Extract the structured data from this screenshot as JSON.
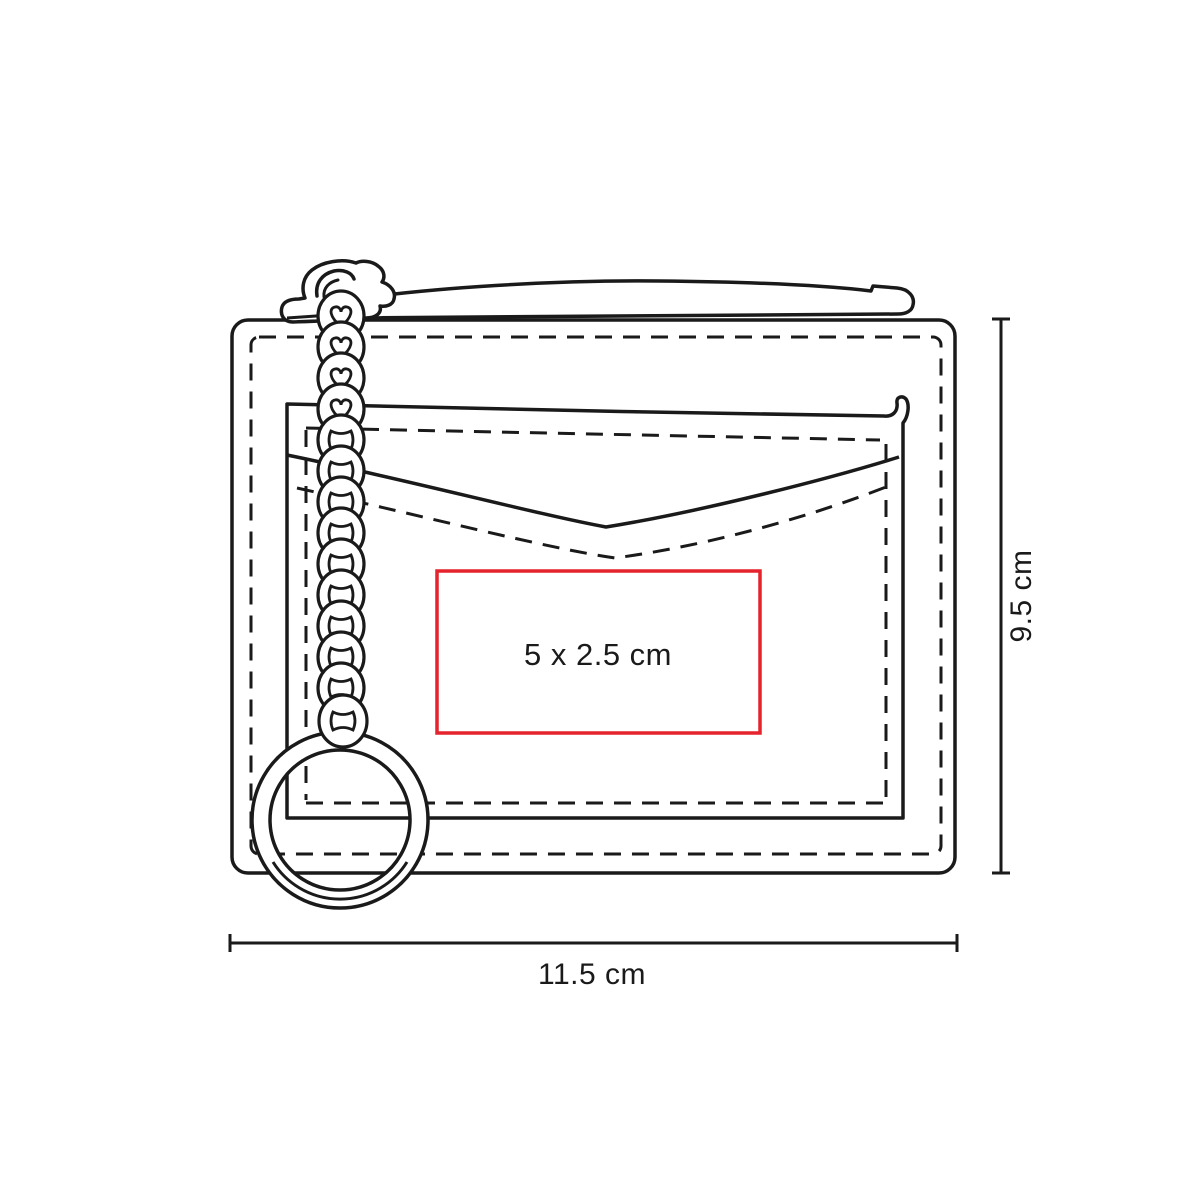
{
  "diagram": {
    "kind": "product-dimension-diagram",
    "shapes": [
      "wallet-body",
      "zipper-band",
      "zipper-pull",
      "heart-link-chain",
      "key-ring",
      "card-pocket",
      "stitching"
    ],
    "print_area": {
      "label": "5 x 2.5 cm",
      "border_color": "#e4232c"
    },
    "dimensions": {
      "height_label": "9.5 cm",
      "width_label": "11.5 cm"
    },
    "colors": {
      "outline": "#1a1a1a",
      "accent_red": "#e4232c",
      "background": "#ffffff",
      "text": "#1a1a1a"
    }
  }
}
